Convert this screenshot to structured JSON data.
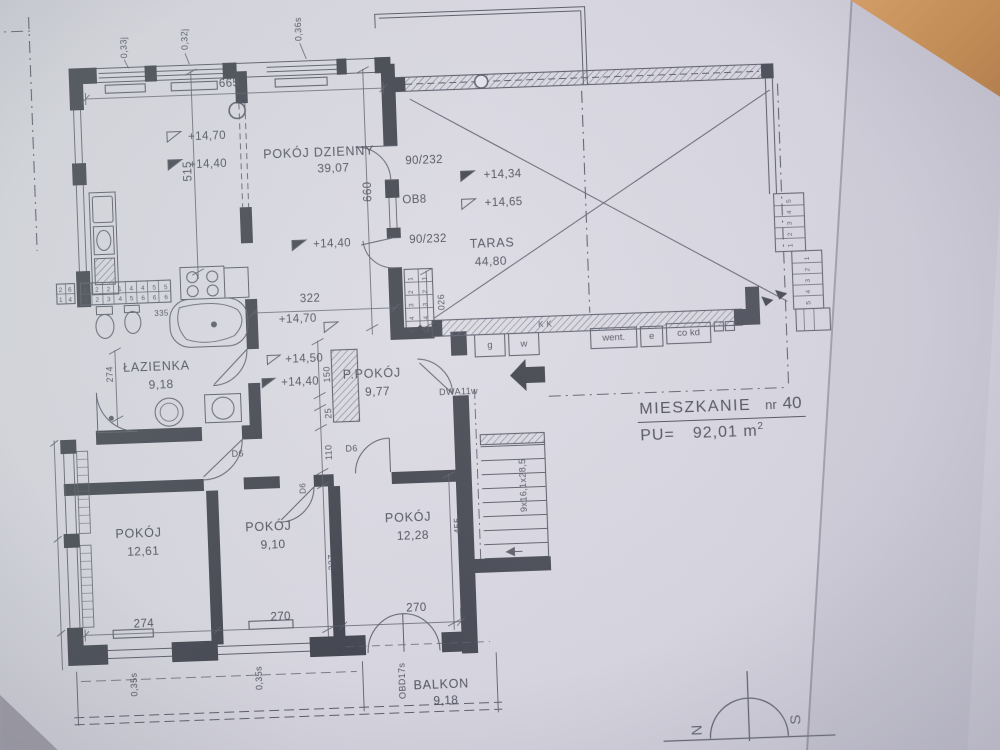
{
  "title": {
    "name": "MIESZKANIE",
    "number_label": "nr",
    "number": "40",
    "pu": "PU=",
    "area": "92,01",
    "unit": "m",
    "unit_sup": "2"
  },
  "rooms": {
    "living": {
      "name": "POKÓJ DZIENNY",
      "area": "39,07"
    },
    "terrace": {
      "name": "TARAS",
      "area": "44,80"
    },
    "bathroom": {
      "name": "ŁAZIENKA",
      "area": "9,18"
    },
    "hall": {
      "name": "P.POKÓJ",
      "area": "9,77"
    },
    "room1": {
      "name": "POKÓJ",
      "area": "12,61"
    },
    "room2": {
      "name": "POKÓJ",
      "area": "9,10"
    },
    "room3": {
      "name": "POKÓJ",
      "area": "12,28"
    },
    "balcony": {
      "name": "BALKON",
      "area": "9,18"
    }
  },
  "levels": {
    "kitchen_upper": "+14,70",
    "kitchen_lower": "+14,40",
    "living": "+14,40",
    "living_door": "+14,70",
    "terrace_upper": "+14,34",
    "terrace_lower": "+14,65",
    "hall_upper": "+14,50",
    "hall_lower": "+14,40"
  },
  "dims": {
    "top_width": "665",
    "kitchen_depth": "515",
    "living_depth": "660",
    "living_width": "322",
    "living_steps": "026",
    "bath_depth": "274",
    "bath_detail": "335",
    "hall_chain": [
      "150",
      "25",
      "110",
      "337"
    ],
    "room1_width": "274",
    "room2_width": "270",
    "room3_width": "270",
    "room3_depth": "455",
    "stair_note": "9x16,1x28,5"
  },
  "windows": {
    "top": [
      "0,33j",
      "0,32j",
      "0,36s"
    ],
    "bottom": [
      "0,35s",
      "0,35s"
    ],
    "balcony_door": "OBD17s"
  },
  "doors": {
    "living_terrace_upper": "90/232",
    "living_window": "OB8",
    "living_terrace_lower": "90/232",
    "entry": "DWA11w",
    "interior": "D6"
  },
  "service": {
    "labels": [
      "g",
      "w",
      "went.",
      "e",
      "co kd"
    ],
    "wall_mark": "K K"
  },
  "steps": {
    "living": "5 4 3 2 1",
    "terrace_upper": "1 2 3 4 5",
    "terrace_lower": "5 4 3 2 1"
  },
  "risers": {
    "top_row": "6 2 2 1 4 4 5 5",
    "bottom_row": "1 2 3 4 5 6 6 6",
    "left_top": "2 6",
    "left_bottom": "1 4"
  },
  "compass": {
    "n": "N",
    "s": "S"
  }
}
